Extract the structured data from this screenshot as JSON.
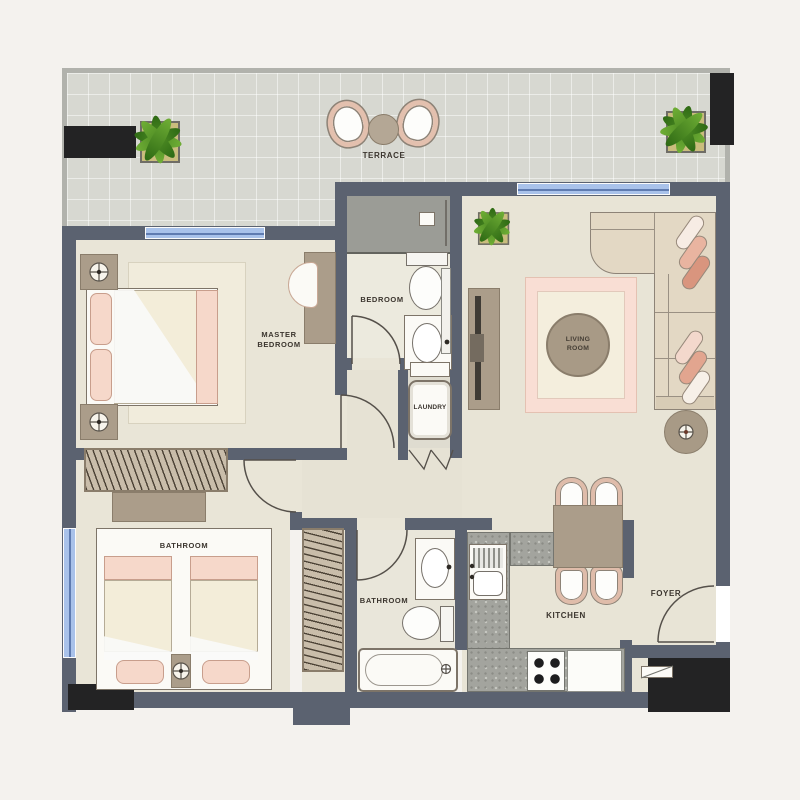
{
  "plan": {
    "labels": {
      "terrace": "TERRACE",
      "master_bedroom": "MASTER BEDROOM",
      "bedroom": "BEDROOM",
      "living_room": "LIVING ROOM",
      "laundry": "LAUNDRY",
      "twin_bedroom": "BATHROOM",
      "bathroom": "BATHROOM",
      "kitchen": "KITCHEN",
      "foyer": "FOYER"
    },
    "colors": {
      "wall": "#5b6270",
      "black": "#232324",
      "floor": "#e9e5d7",
      "terrace": "#d7d8d1",
      "window": "#a9c2ea",
      "counter": "#a3a49e",
      "tan": "#ab9d8a",
      "pink": "#f6d8ca",
      "rugpink": "#f9ded4",
      "green": "#4c8426",
      "cream": "#f3edd9",
      "white": "#fbfaf6",
      "ink": "#3b352e"
    },
    "icons": {
      "plant": "potted-plant",
      "lamp": "table-lamp",
      "door": "door-swing-arc",
      "washer": "washing-machine",
      "stove": "four-burner-stove"
    }
  }
}
